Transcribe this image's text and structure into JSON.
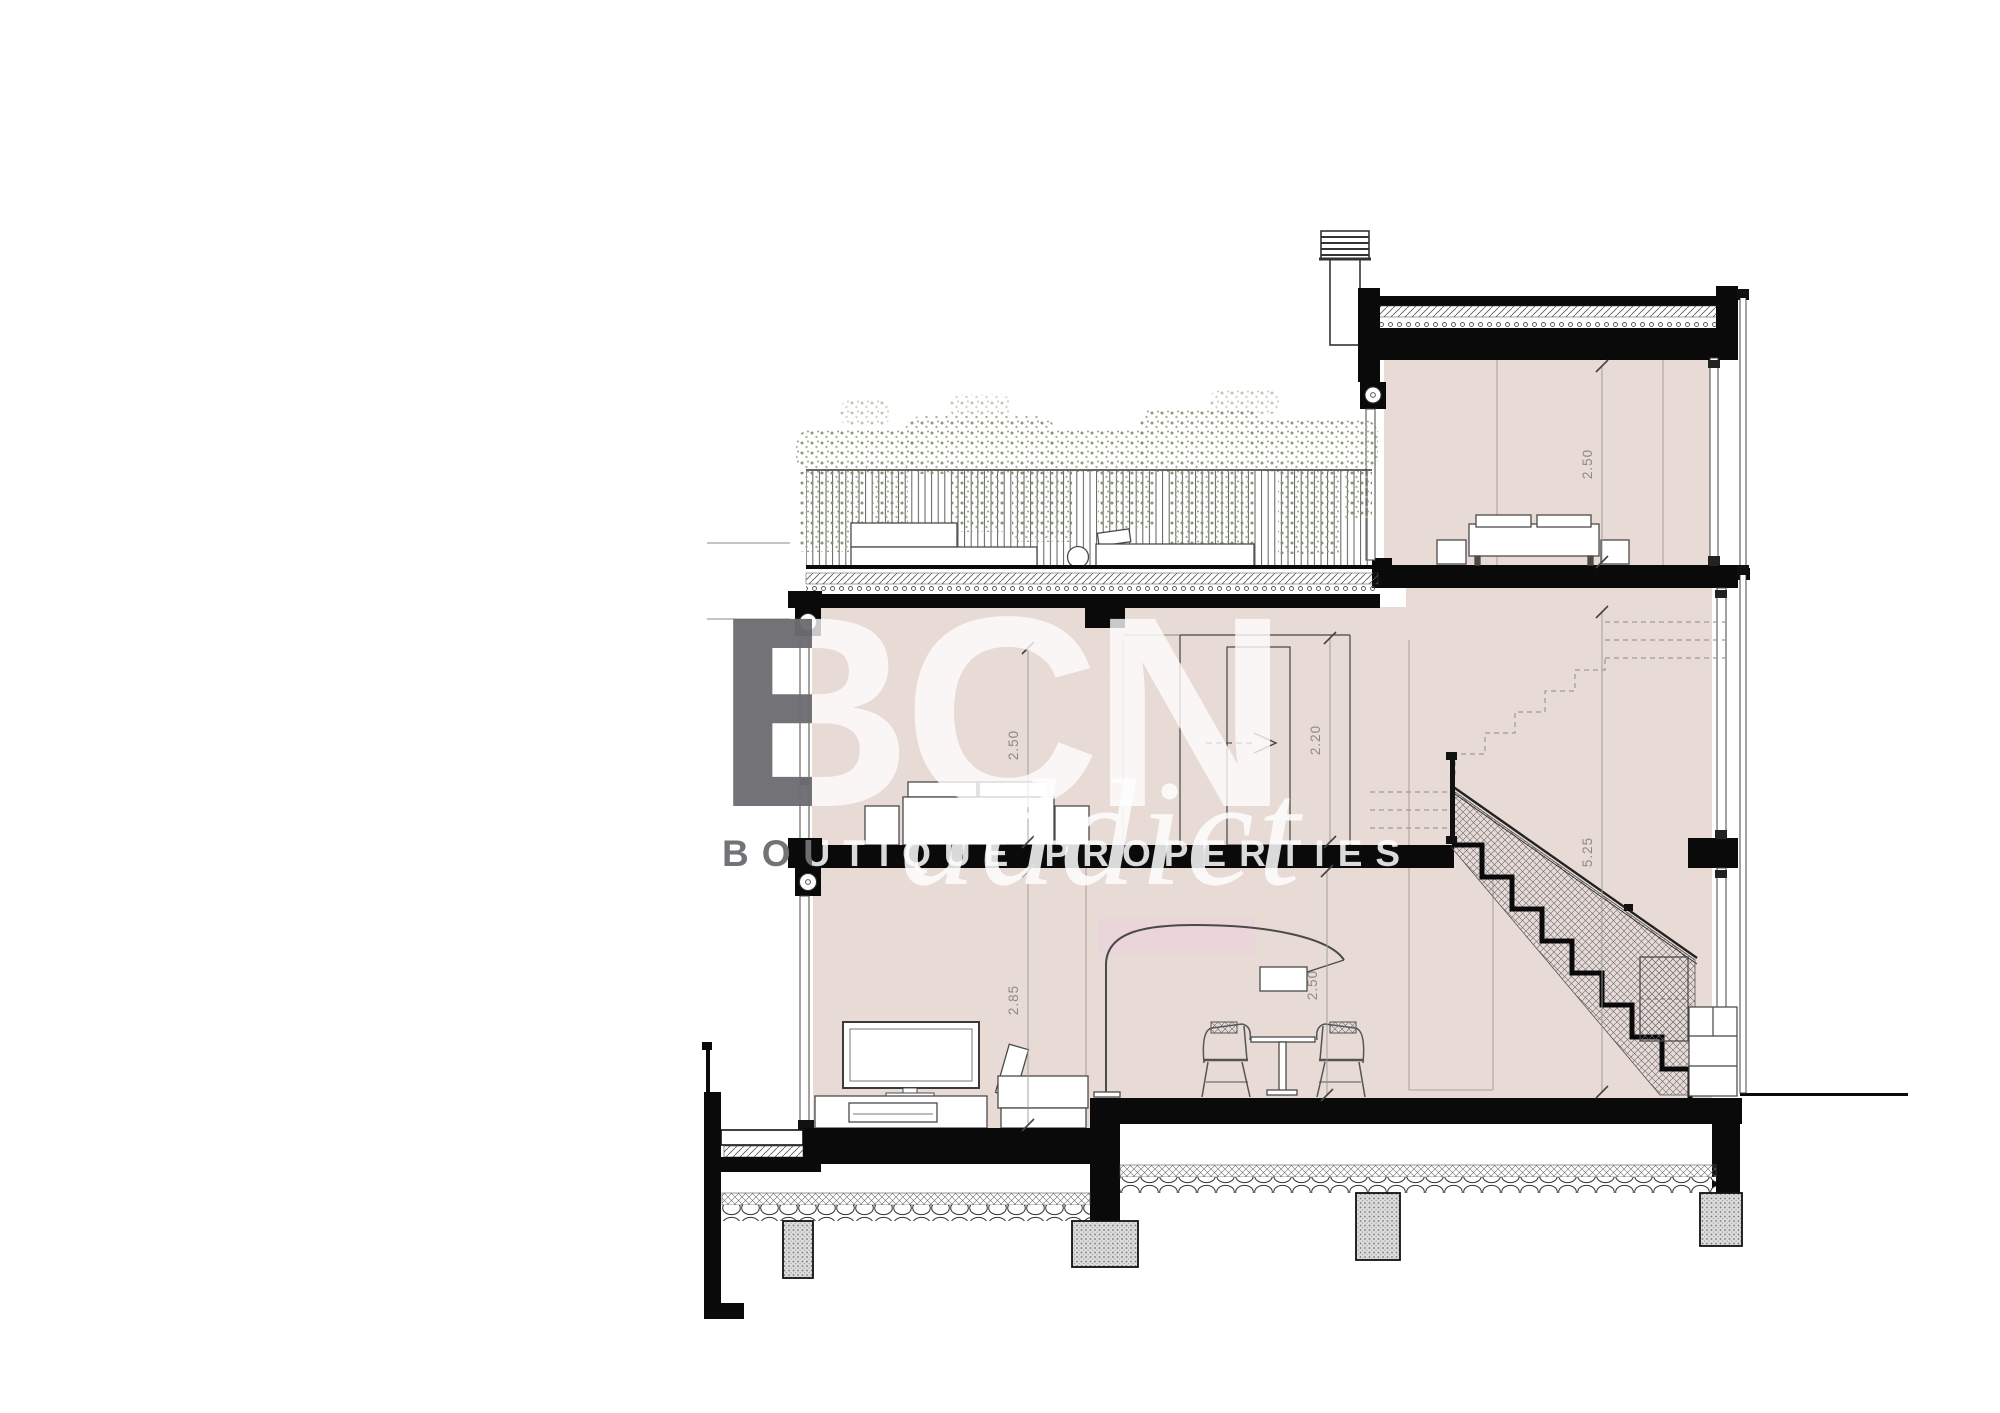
{
  "drawing": {
    "type": "architectural-cross-section",
    "watermark": {
      "brand": "BCN",
      "sub_brand": "addict",
      "tagline": "BOUTIQUE PROPERTIES"
    },
    "dimensions": {
      "middle_room_height": "2.50",
      "ground_room_height": "2.85",
      "door_height": "2.20",
      "top_room_height": "2.50",
      "stair_void_height": "5.25",
      "dining_room_height": "2.50"
    },
    "colors": {
      "section_cut_black": "#0a0a0a",
      "wall_fill_pink": "#e8dad5",
      "highlight_pink": "#ecd2e0",
      "plant_green": "#8ea077",
      "dimension_gray": "#8a8a8a",
      "watermark_white": "#ffffff",
      "watermark_gray": "#55555a"
    }
  }
}
